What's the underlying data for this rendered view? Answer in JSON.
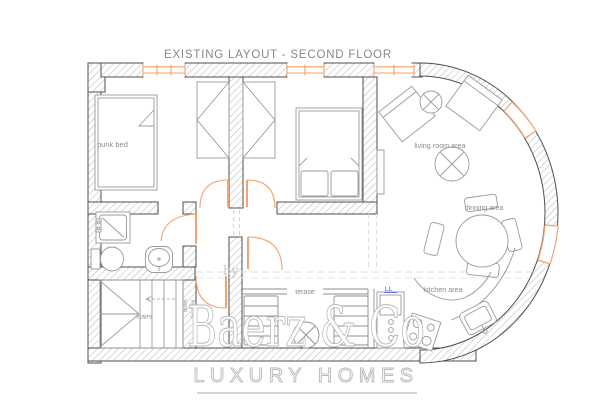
{
  "title": "EXISTING LAYOUT - SECOND FLOOR",
  "labels": {
    "bunk_bed": "bunk bed",
    "living_room": "living room area",
    "dinning": "dinning area",
    "kitchen": "kitchen area",
    "terase": "terase",
    "stairs": "stairs",
    "down": "down",
    "firs_floor": "firs floor",
    "by": "by",
    "mark": "LL"
  },
  "watermark": {
    "brand": "Baerz & Co",
    "tagline": "LUXURY HOMES"
  },
  "colors": {
    "wall_line": "#4f4f4f",
    "hatch": "#adadad",
    "window_orange": "#f2a36f",
    "furniture_gray": "#9a9a9a",
    "label_gray": "#8a8a8a",
    "watermark_gray": "#bcbcbc",
    "dashed_gray": "#dcdcdc",
    "mark_blue": "#4a55c8"
  }
}
